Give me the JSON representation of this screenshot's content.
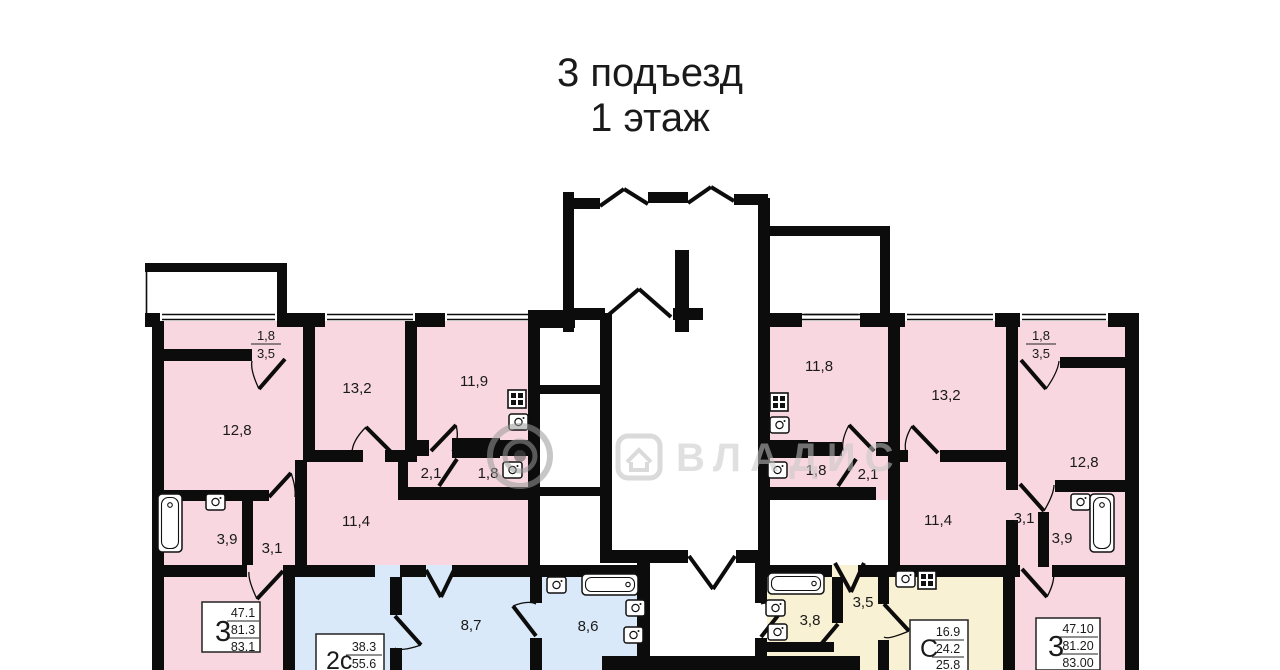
{
  "title": {
    "entrance": "3 подъезд",
    "floor": "1 этаж"
  },
  "watermark": {
    "agency": "ВЛАДИС"
  },
  "apartments": [
    {
      "id": "apt-3room-left",
      "type_label": "3",
      "area_values": [
        "47.1",
        "81.3",
        "83.1"
      ],
      "rooms": {
        "balcony_a": "1,8",
        "balcony_b": "3,5",
        "bedroom": "12,8",
        "living": "13,2",
        "kitchen": "11,9",
        "wc": "2,1",
        "toilet": "1,8",
        "hallway": "11,4",
        "bathroom": "3,9",
        "hall": "3,1"
      }
    },
    {
      "id": "apt-2s",
      "type_label": "2с",
      "area_values": [
        "38.3",
        "55.6"
      ],
      "rooms": {
        "room_a": "8,7",
        "room_b": "8,6"
      }
    },
    {
      "id": "apt-studio",
      "type_label": "С",
      "area_values": [
        "16.9",
        "24.2",
        "25.8"
      ],
      "rooms": {
        "bathroom": "3,8",
        "hall": "3,5"
      }
    },
    {
      "id": "apt-3room-right",
      "type_label": "3",
      "area_values": [
        "47.10",
        "81.20",
        "83.00"
      ],
      "rooms": {
        "kitchen": "11,8",
        "living": "13,2",
        "balcony_a": "1,8",
        "balcony_b": "3,5",
        "bedroom": "12,8",
        "toilet": "1,8",
        "wc": "2,1",
        "hallway": "11,4",
        "hall": "3,1",
        "bathroom": "3,9"
      }
    }
  ]
}
